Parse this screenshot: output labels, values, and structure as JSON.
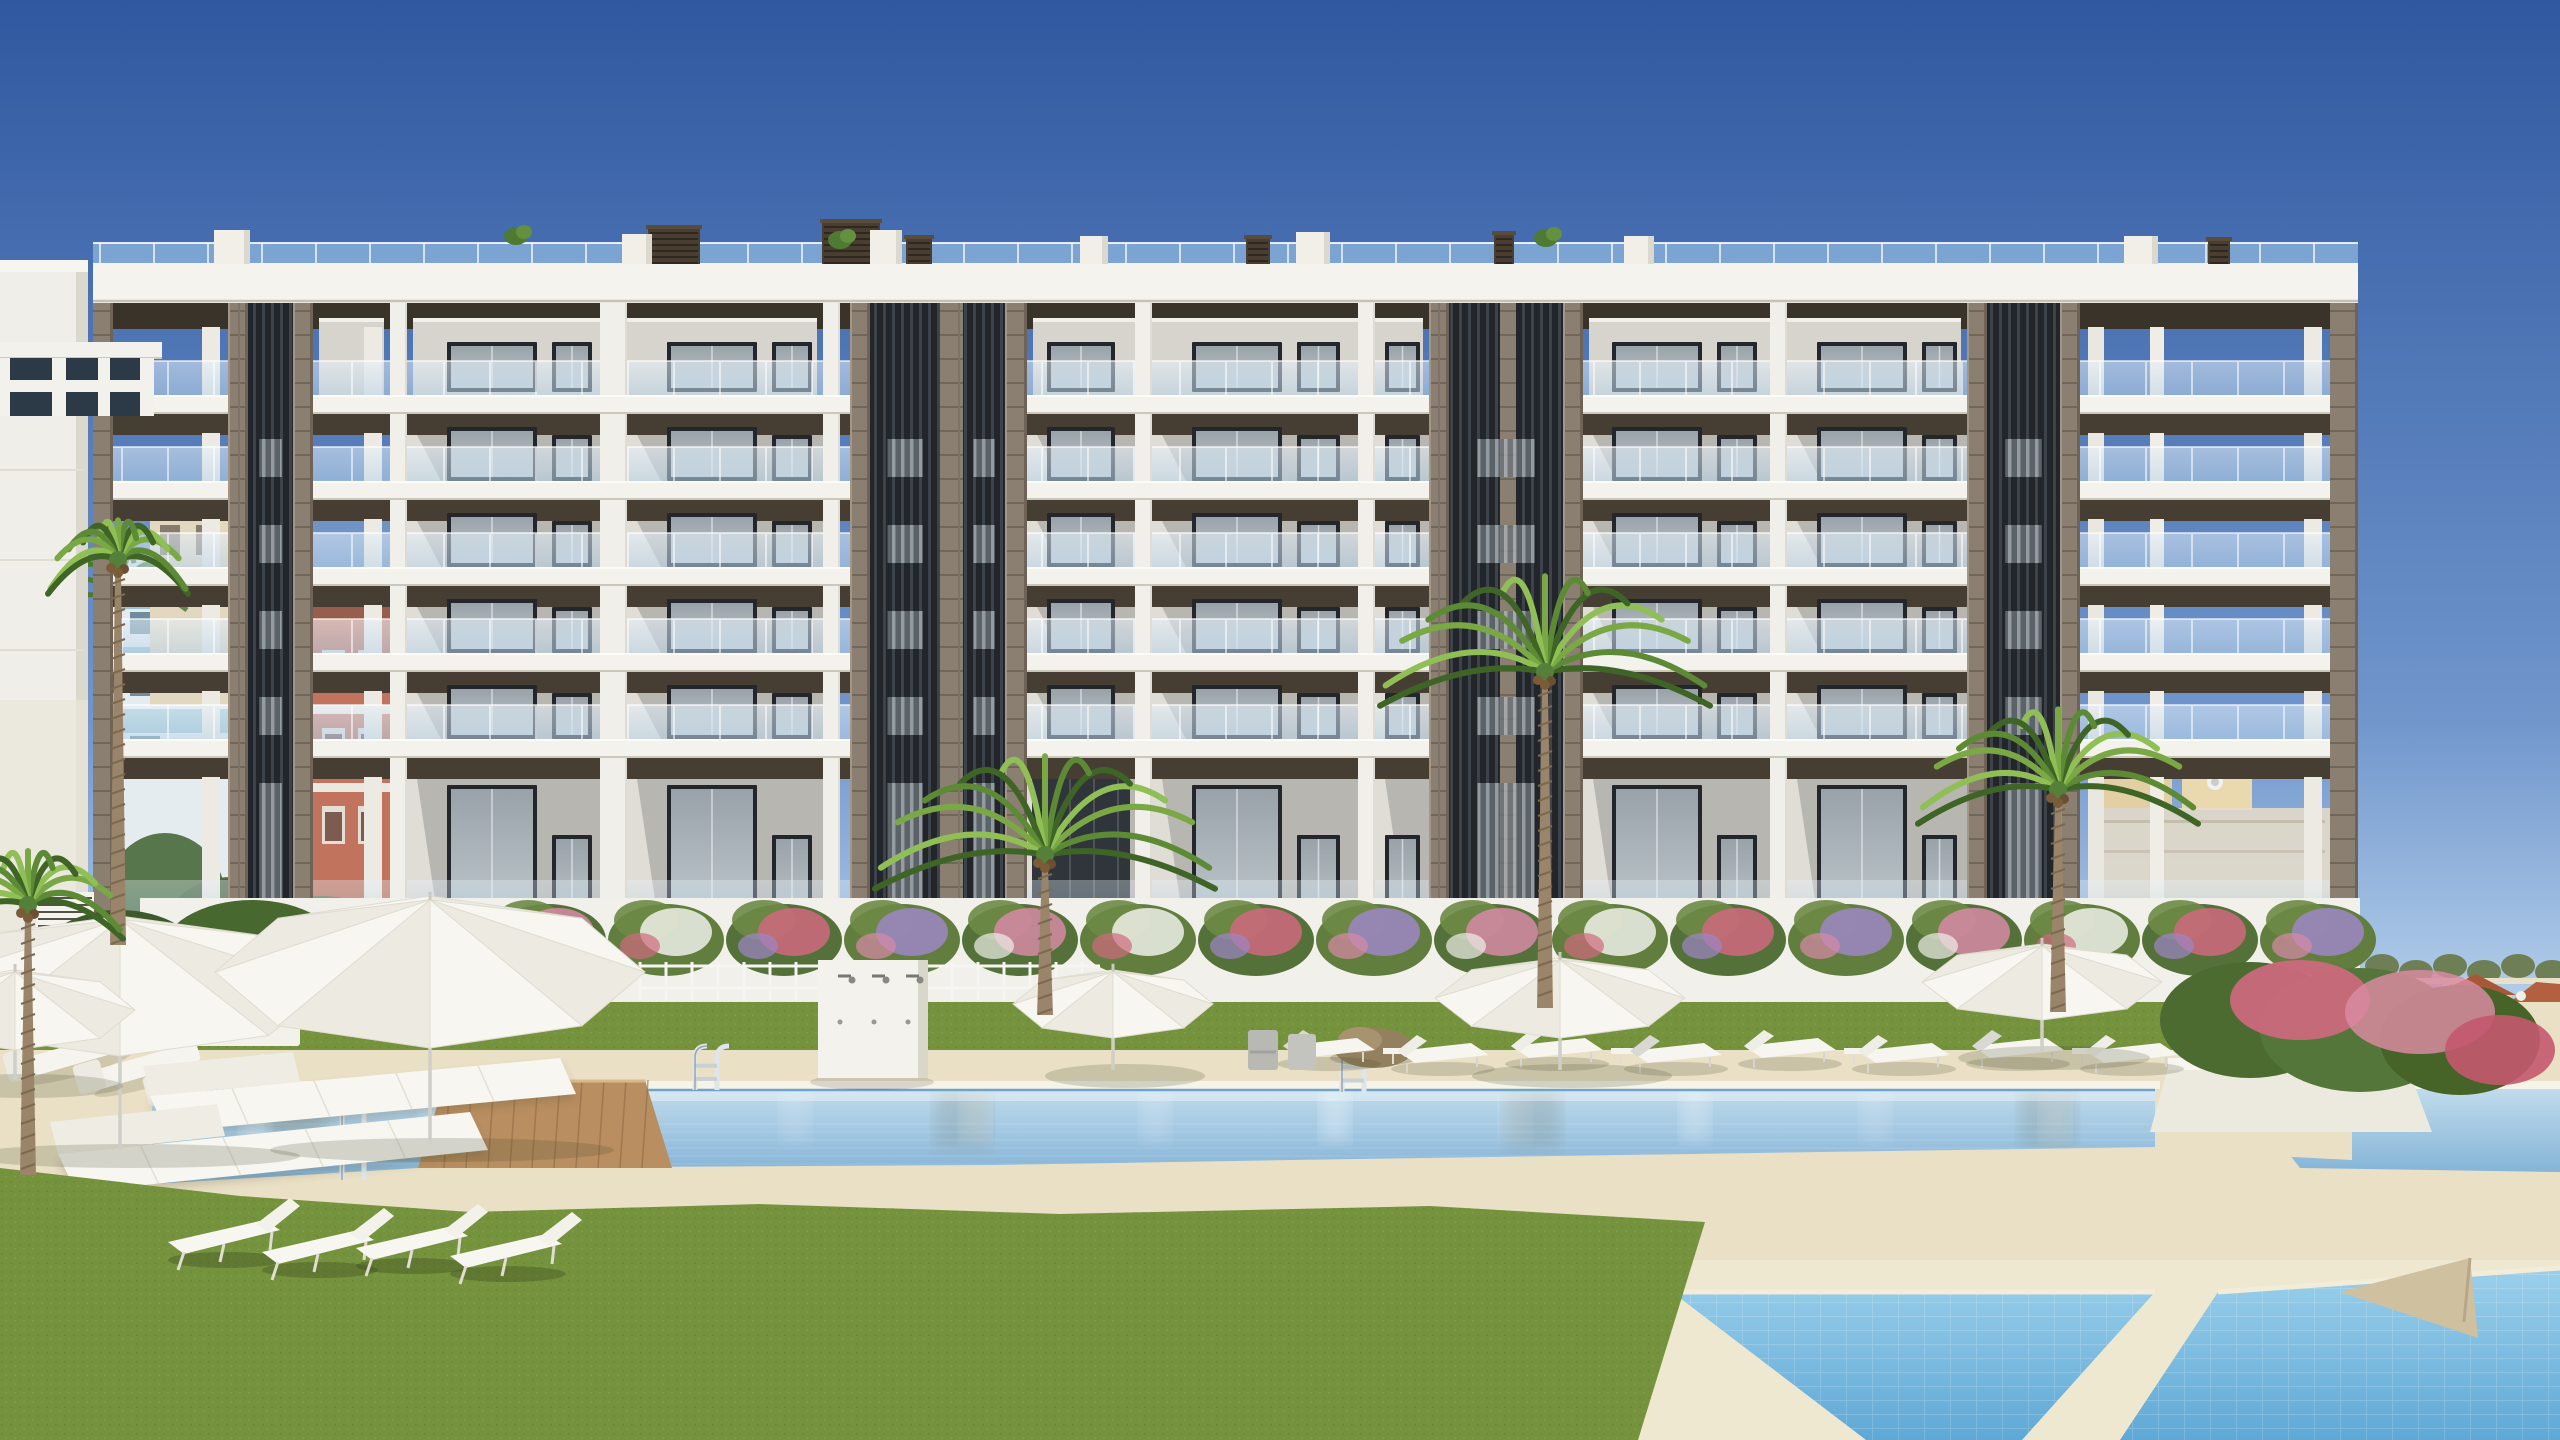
{
  "scene": {
    "type": "architectural-render",
    "title": "",
    "description": "Photorealistic rendering of a modern six-storey white residential building with rooftop glass balustrade, dark vertical louver cores, glass-fronted balconies, and a landscaped pool area with white parasols, sun loungers, double sunbeds, palm trees, flowering hedges and lawns; Mediterranean buildings in the background.",
    "sky": {
      "top": "#2f58a0",
      "mid": "#7096cc",
      "horizon": "#cfe6f7"
    },
    "palette": {
      "slab_white": "#f3f2ec",
      "parapet_white": "#f4f3ed",
      "wall_grey": "#b8b6b1",
      "soffit_dark": "#473e33",
      "attic_soffit": "#3a332a",
      "louver_dark": "#22262a",
      "louver_light": "#aab2b8",
      "stone_taupe": "#8b7f71",
      "glass_roof": "#aad0ee",
      "window_frame": "#23262b",
      "window_glass": "#a8b1b6",
      "pool_far": "#c6dfee",
      "pool_near": "#7aacd2",
      "kids_pool_light": "#9ed2ec",
      "kids_pool_deep": "#5fa8d6",
      "deck_sand": "#e9e0c6",
      "wood_deck": "#b98e60",
      "grass_green": "#75923d",
      "foliage_dark": "#3f5c2e",
      "palm_green": "#4e7a2e",
      "palm_trunk": "#9b856a",
      "flower_pink": "#d78aa6",
      "flower_purple": "#9d86c6",
      "flower_rose": "#d0697f",
      "flower_red": "#c4504e",
      "furniture_white": "#f6f5f0",
      "terracotta": "#b2603e",
      "cream_house": "#ead9a8",
      "neighbor_white": "#efeee9"
    },
    "counts": {
      "visible_storeys": 6,
      "louver_cores": 4,
      "roof_chimneys": 6,
      "roof_bulkheads": 7,
      "parasols": 6,
      "palm_trees": 5,
      "pool_ladders": 3,
      "double_sunbeds": 2,
      "lawn_loungers": 4,
      "poolside_loungers": 8,
      "pools": 3
    },
    "labels": {
      "building": "apartment-building",
      "main_pool": "swimming-pool",
      "kids_pool": "childrens-pool",
      "lawn": "lawn",
      "deck": "pool-deck",
      "wall": "garden-wall"
    }
  }
}
